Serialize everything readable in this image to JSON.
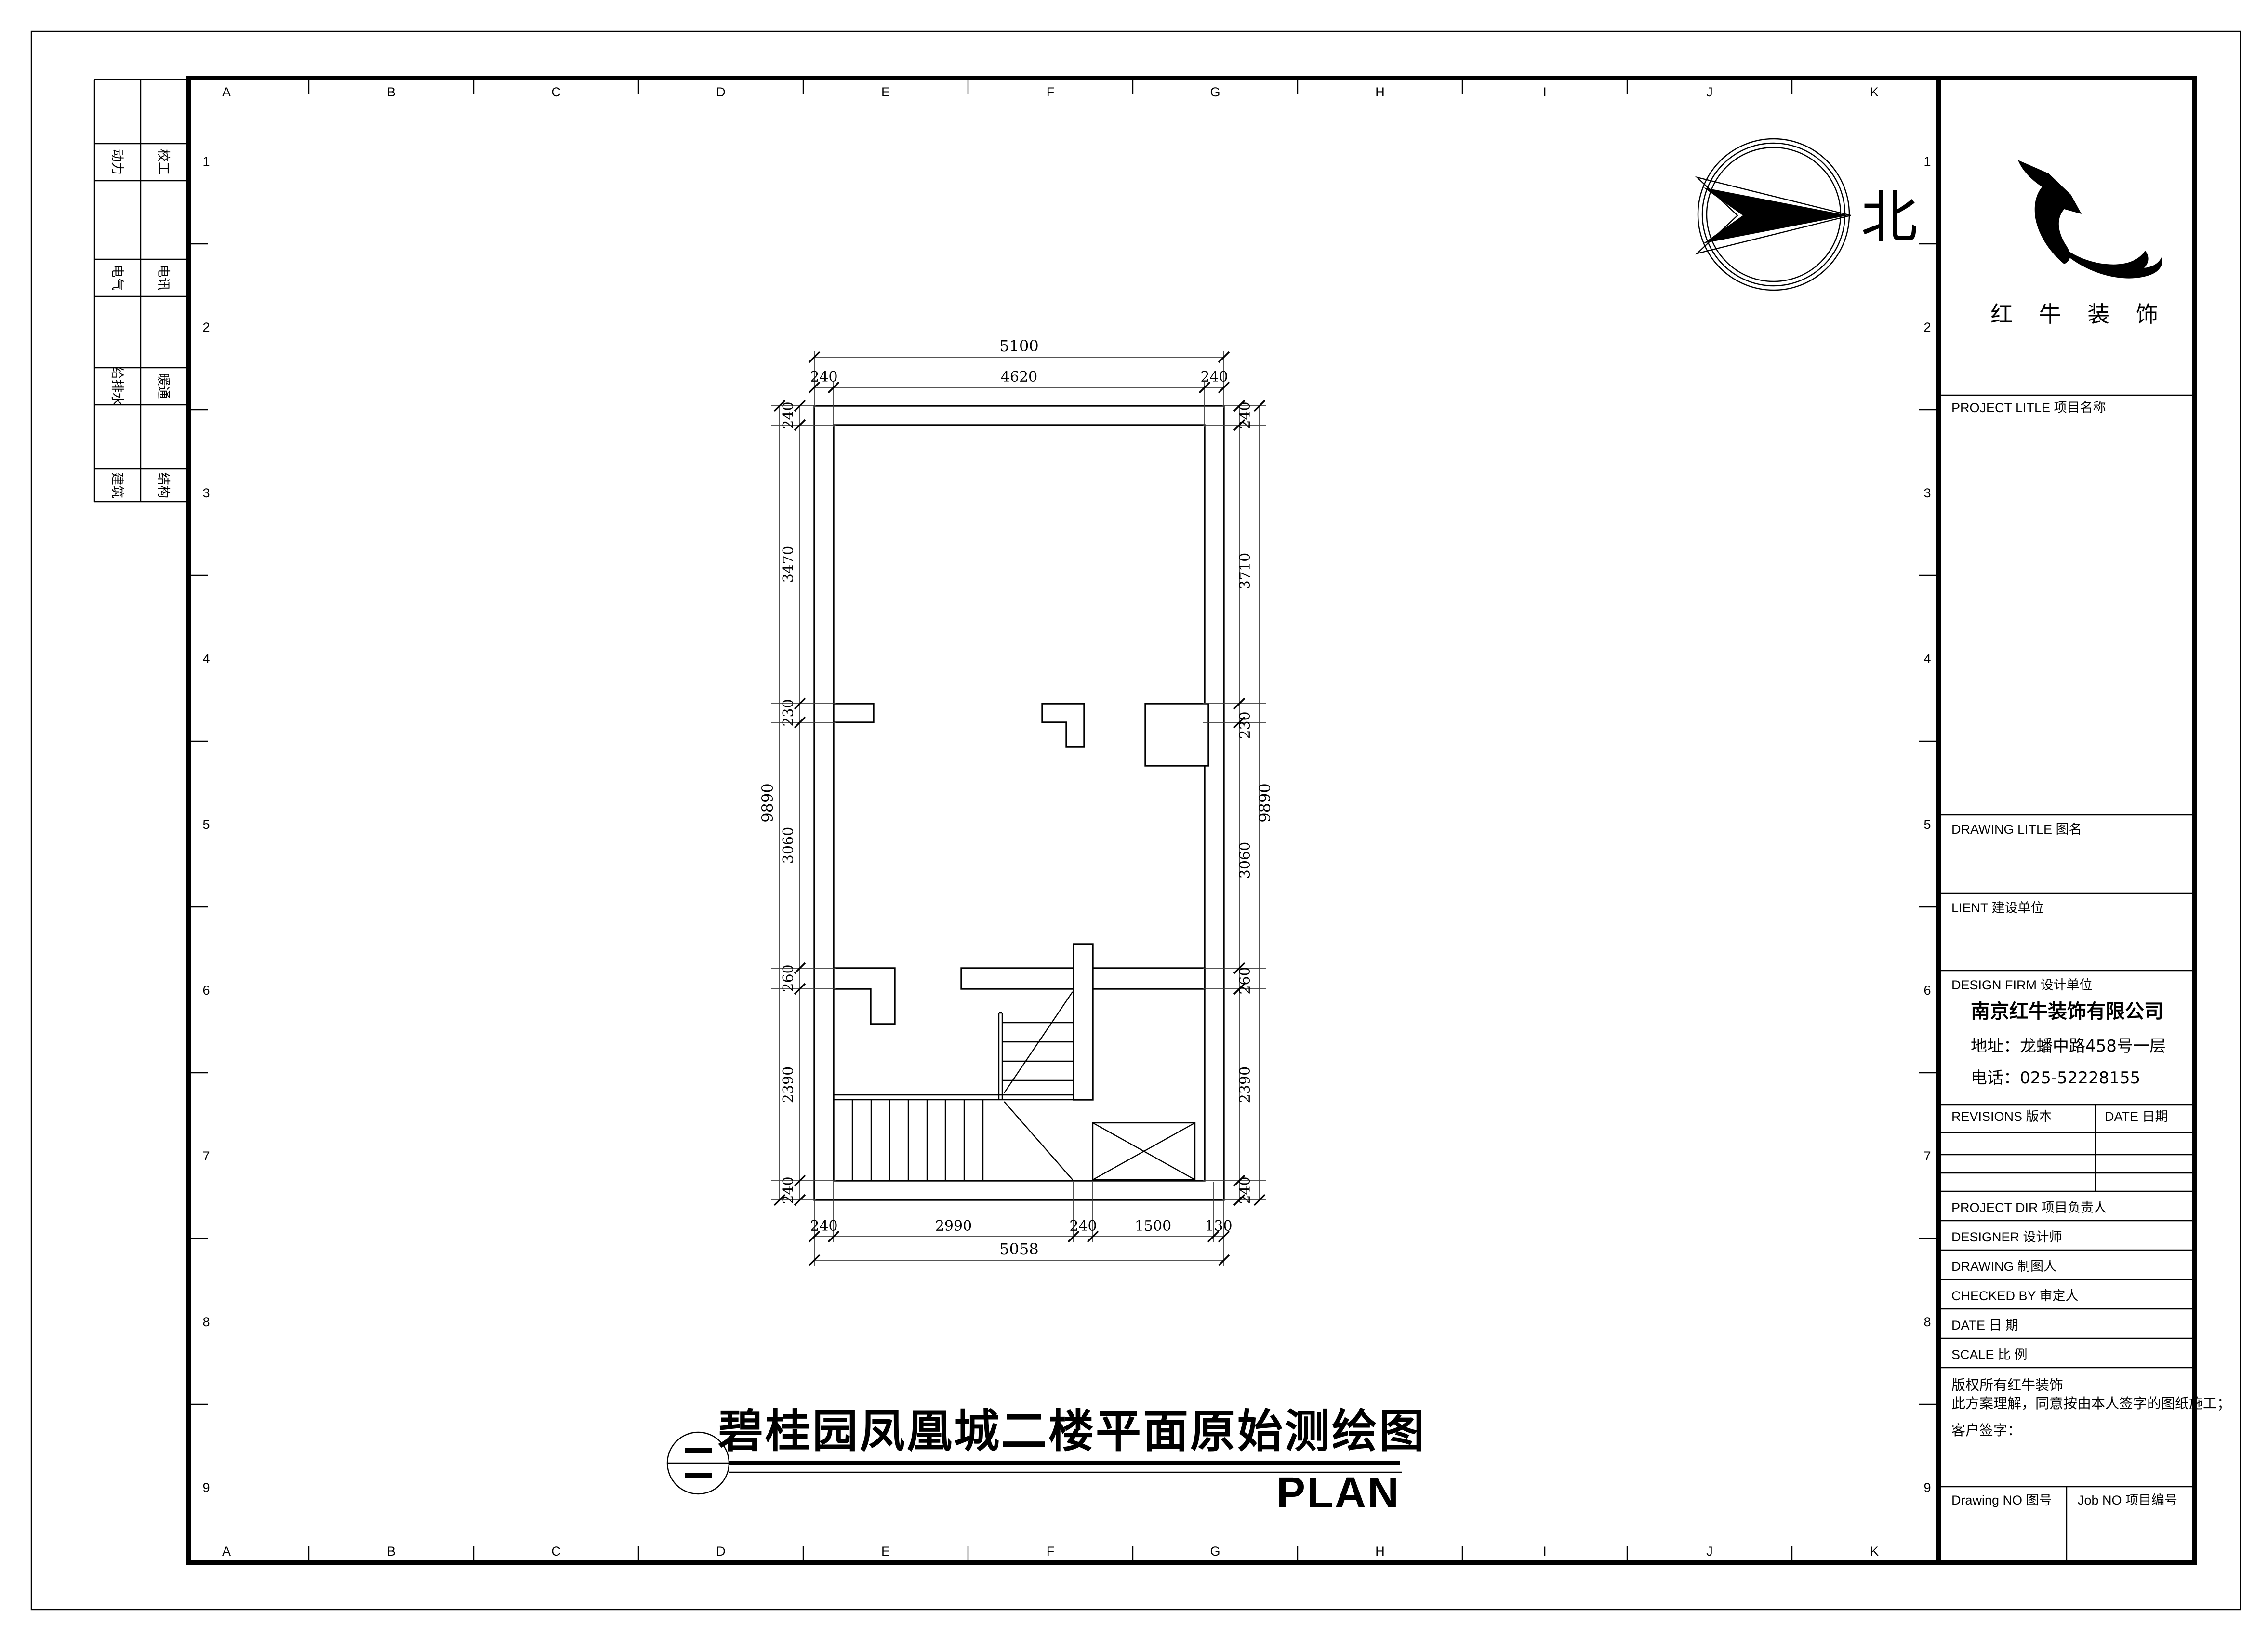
{
  "sheet": {
    "grid_columns": [
      "A",
      "B",
      "C",
      "D",
      "E",
      "F",
      "G",
      "H",
      "I",
      "J",
      "K"
    ],
    "grid_rows": [
      "1",
      "2",
      "3",
      "4",
      "5",
      "6",
      "7",
      "8",
      "9"
    ],
    "disciplines": {
      "col1": [
        "动力",
        "电气",
        "给排水",
        "建筑"
      ],
      "col2": [
        "校工",
        "电讯",
        "暖通",
        "结构"
      ]
    }
  },
  "north_label": "北",
  "drawing": {
    "title": "碧桂园凤凰城二楼平面原始测绘图",
    "plan_label": "PLAN",
    "dims": {
      "top_overall": "5100",
      "top_chain": [
        "240",
        "4620",
        "240"
      ],
      "left_overall": "9890",
      "left_chain": [
        "240",
        "3470",
        "230",
        "3060",
        "260",
        "2390",
        "240"
      ],
      "right_overall": "9890",
      "right_chain": [
        "240",
        "3710",
        "230",
        "3060",
        "260",
        "2390",
        "240"
      ],
      "bottom_chain": [
        "240",
        "2990",
        "240",
        "1500",
        "130"
      ],
      "bottom_overall": "5058"
    }
  },
  "titleblock": {
    "logo_text": "红 牛 装 饰",
    "project_title_label": "PROJECT LITLE    项目名称",
    "drawing_title_label": "DRAWING LITLE    图名",
    "client_label": "LIENT   建设单位",
    "design_firm_label": "DESIGN FIRM    设计单位",
    "company_name": "南京红牛装饰有限公司",
    "company_address": "地址：龙蟠中路458号一层",
    "company_phone": "电话：025-52228155",
    "revisions_label": "REVISIONS  版本",
    "date_header_label": "DATE  日期",
    "project_dir_label": "PROJECT DIR    项目负责人",
    "designer_label": "DESIGNER       设计师",
    "drawing_by_label": "DRAWING        制图人",
    "checked_by_label": "CHECKED BY   审定人",
    "date_label": "DATE                日   期",
    "scale_label": "SCALE              比   例",
    "copyright_line1": "版权所有红牛装饰",
    "copyright_line2": "此方案理解，同意按由本人签字的图纸施工；",
    "client_sign_label": "客户签字：",
    "drawing_no_label": "Drawing NO  图号",
    "job_no_label": "Job NO  项目编号"
  }
}
